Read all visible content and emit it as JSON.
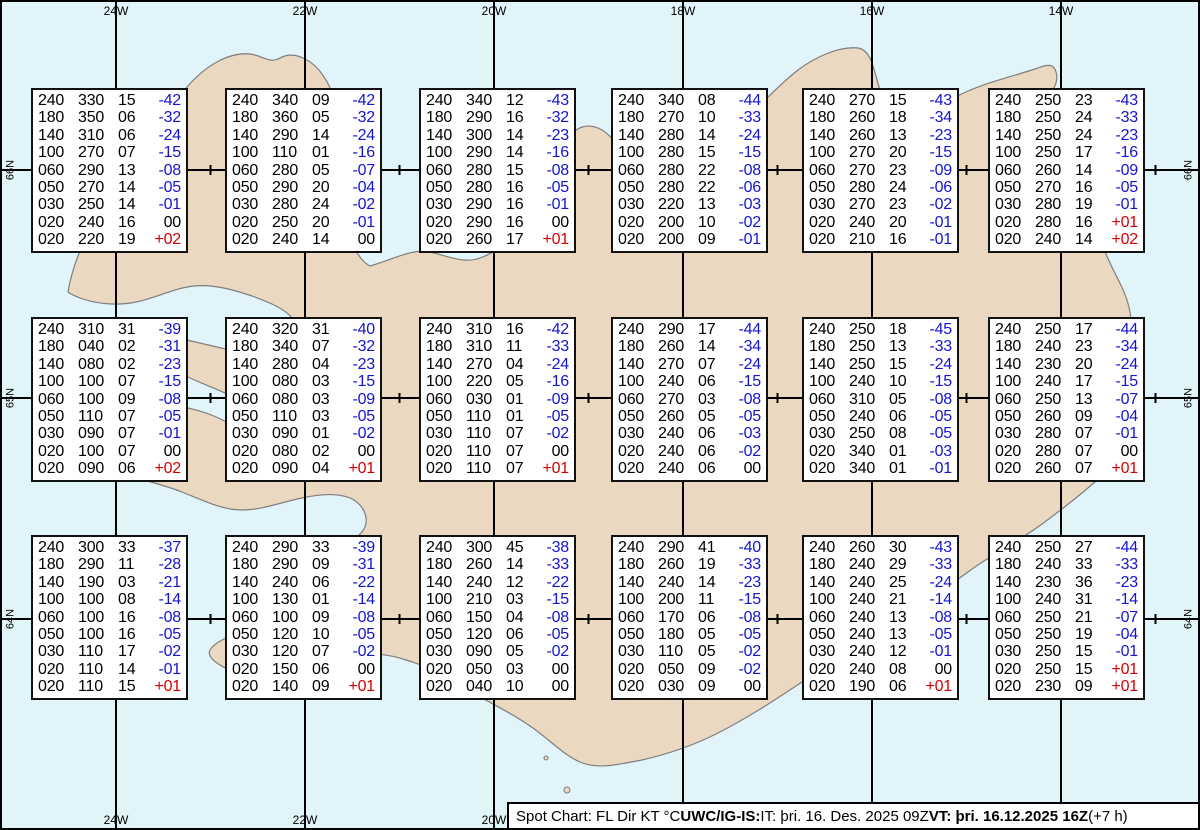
{
  "map": {
    "sea_color": "#e1f4fa",
    "land_color": "#ead8c1",
    "coast_color": "#7e7e7e",
    "grid_color": "#000000",
    "meridians": [
      {
        "label": "24W",
        "x": 116
      },
      {
        "label": "22W",
        "x": 305
      },
      {
        "label": "20W",
        "x": 494
      },
      {
        "label": "18W",
        "x": 683
      },
      {
        "label": "16W",
        "x": 872
      },
      {
        "label": "14W",
        "x": 1061
      }
    ],
    "parallels": [
      {
        "label": "66N",
        "y": 170
      },
      {
        "label": "65N",
        "y": 398
      },
      {
        "label": "64N",
        "y": 619
      }
    ],
    "tick_xs": [
      210.5,
      399.5,
      588.5,
      777.5,
      966.5,
      1155.5
    ]
  },
  "spot_columns": [
    "FL",
    "Dir",
    "KT",
    "°C"
  ],
  "colors": {
    "temp_negative": "#1414d4",
    "temp_positive": "#d40000",
    "text": "#000000"
  },
  "spot_boxes": [
    {
      "x": 31,
      "y": 88,
      "rows": [
        [
          "240",
          "330",
          "15",
          "-42"
        ],
        [
          "180",
          "350",
          "06",
          "-32"
        ],
        [
          "140",
          "310",
          "06",
          "-24"
        ],
        [
          "100",
          "270",
          "07",
          "-15"
        ],
        [
          "060",
          "290",
          "13",
          "-08"
        ],
        [
          "050",
          "270",
          "14",
          "-05"
        ],
        [
          "030",
          "250",
          "14",
          "-01"
        ],
        [
          "020",
          "240",
          "16",
          "00"
        ],
        [
          "020",
          "220",
          "19",
          "+02"
        ]
      ]
    },
    {
      "x": 225,
      "y": 88,
      "rows": [
        [
          "240",
          "340",
          "09",
          "-42"
        ],
        [
          "180",
          "360",
          "05",
          "-32"
        ],
        [
          "140",
          "290",
          "14",
          "-24"
        ],
        [
          "100",
          "110",
          "01",
          "-16"
        ],
        [
          "060",
          "280",
          "05",
          "-07"
        ],
        [
          "050",
          "290",
          "20",
          "-04"
        ],
        [
          "030",
          "280",
          "24",
          "-02"
        ],
        [
          "020",
          "250",
          "20",
          "-01"
        ],
        [
          "020",
          "240",
          "14",
          "00"
        ]
      ]
    },
    {
      "x": 419,
      "y": 88,
      "rows": [
        [
          "240",
          "340",
          "12",
          "-43"
        ],
        [
          "180",
          "290",
          "16",
          "-32"
        ],
        [
          "140",
          "300",
          "14",
          "-23"
        ],
        [
          "100",
          "290",
          "14",
          "-16"
        ],
        [
          "060",
          "280",
          "15",
          "-08"
        ],
        [
          "050",
          "280",
          "16",
          "-05"
        ],
        [
          "030",
          "290",
          "16",
          "-01"
        ],
        [
          "020",
          "290",
          "16",
          "00"
        ],
        [
          "020",
          "260",
          "17",
          "+01"
        ]
      ]
    },
    {
      "x": 611,
      "y": 88,
      "rows": [
        [
          "240",
          "340",
          "08",
          "-44"
        ],
        [
          "180",
          "270",
          "10",
          "-33"
        ],
        [
          "140",
          "280",
          "14",
          "-24"
        ],
        [
          "100",
          "280",
          "15",
          "-15"
        ],
        [
          "060",
          "280",
          "22",
          "-08"
        ],
        [
          "050",
          "280",
          "22",
          "-06"
        ],
        [
          "030",
          "220",
          "13",
          "-03"
        ],
        [
          "020",
          "200",
          "10",
          "-02"
        ],
        [
          "020",
          "200",
          "09",
          "-01"
        ]
      ]
    },
    {
      "x": 802,
      "y": 88,
      "rows": [
        [
          "240",
          "270",
          "15",
          "-43"
        ],
        [
          "180",
          "260",
          "18",
          "-34"
        ],
        [
          "140",
          "260",
          "13",
          "-23"
        ],
        [
          "100",
          "270",
          "20",
          "-15"
        ],
        [
          "060",
          "270",
          "23",
          "-09"
        ],
        [
          "050",
          "280",
          "24",
          "-06"
        ],
        [
          "030",
          "270",
          "23",
          "-02"
        ],
        [
          "020",
          "240",
          "20",
          "-01"
        ],
        [
          "020",
          "210",
          "16",
          "-01"
        ]
      ]
    },
    {
      "x": 988,
      "y": 88,
      "rows": [
        [
          "240",
          "250",
          "23",
          "-43"
        ],
        [
          "180",
          "250",
          "24",
          "-33"
        ],
        [
          "140",
          "250",
          "24",
          "-23"
        ],
        [
          "100",
          "250",
          "17",
          "-16"
        ],
        [
          "060",
          "260",
          "14",
          "-09"
        ],
        [
          "050",
          "270",
          "16",
          "-05"
        ],
        [
          "030",
          "280",
          "19",
          "-01"
        ],
        [
          "020",
          "280",
          "16",
          "+01"
        ],
        [
          "020",
          "240",
          "14",
          "+02"
        ]
      ]
    },
    {
      "x": 31,
      "y": 317,
      "rows": [
        [
          "240",
          "310",
          "31",
          "-39"
        ],
        [
          "180",
          "040",
          "02",
          "-31"
        ],
        [
          "140",
          "080",
          "02",
          "-23"
        ],
        [
          "100",
          "100",
          "07",
          "-15"
        ],
        [
          "060",
          "100",
          "09",
          "-08"
        ],
        [
          "050",
          "110",
          "07",
          "-05"
        ],
        [
          "030",
          "090",
          "07",
          "-01"
        ],
        [
          "020",
          "100",
          "07",
          "00"
        ],
        [
          "020",
          "090",
          "06",
          "+02"
        ]
      ]
    },
    {
      "x": 225,
      "y": 317,
      "rows": [
        [
          "240",
          "320",
          "31",
          "-40"
        ],
        [
          "180",
          "340",
          "07",
          "-32"
        ],
        [
          "140",
          "280",
          "04",
          "-23"
        ],
        [
          "100",
          "080",
          "03",
          "-15"
        ],
        [
          "060",
          "080",
          "03",
          "-09"
        ],
        [
          "050",
          "110",
          "03",
          "-05"
        ],
        [
          "030",
          "090",
          "01",
          "-02"
        ],
        [
          "020",
          "080",
          "02",
          "00"
        ],
        [
          "020",
          "090",
          "04",
          "+01"
        ]
      ]
    },
    {
      "x": 419,
      "y": 317,
      "rows": [
        [
          "240",
          "310",
          "16",
          "-42"
        ],
        [
          "180",
          "310",
          "11",
          "-33"
        ],
        [
          "140",
          "270",
          "04",
          "-24"
        ],
        [
          "100",
          "220",
          "05",
          "-16"
        ],
        [
          "060",
          "030",
          "01",
          "-09"
        ],
        [
          "050",
          "110",
          "01",
          "-05"
        ],
        [
          "030",
          "110",
          "07",
          "-02"
        ],
        [
          "020",
          "110",
          "07",
          "00"
        ],
        [
          "020",
          "110",
          "07",
          "+01"
        ]
      ]
    },
    {
      "x": 611,
      "y": 317,
      "rows": [
        [
          "240",
          "290",
          "17",
          "-44"
        ],
        [
          "180",
          "260",
          "14",
          "-34"
        ],
        [
          "140",
          "270",
          "07",
          "-24"
        ],
        [
          "100",
          "240",
          "06",
          "-15"
        ],
        [
          "060",
          "270",
          "03",
          "-08"
        ],
        [
          "050",
          "260",
          "05",
          "-05"
        ],
        [
          "030",
          "240",
          "06",
          "-03"
        ],
        [
          "020",
          "240",
          "06",
          "-02"
        ],
        [
          "020",
          "240",
          "06",
          "00"
        ]
      ]
    },
    {
      "x": 802,
      "y": 317,
      "rows": [
        [
          "240",
          "250",
          "18",
          "-45"
        ],
        [
          "180",
          "250",
          "13",
          "-33"
        ],
        [
          "140",
          "250",
          "15",
          "-24"
        ],
        [
          "100",
          "240",
          "10",
          "-15"
        ],
        [
          "060",
          "310",
          "05",
          "-08"
        ],
        [
          "050",
          "240",
          "06",
          "-05"
        ],
        [
          "030",
          "250",
          "08",
          "-05"
        ],
        [
          "020",
          "340",
          "01",
          "-03"
        ],
        [
          "020",
          "340",
          "01",
          "-01"
        ]
      ]
    },
    {
      "x": 988,
      "y": 317,
      "rows": [
        [
          "240",
          "250",
          "17",
          "-44"
        ],
        [
          "180",
          "240",
          "23",
          "-34"
        ],
        [
          "140",
          "230",
          "20",
          "-24"
        ],
        [
          "100",
          "240",
          "17",
          "-15"
        ],
        [
          "060",
          "250",
          "13",
          "-07"
        ],
        [
          "050",
          "260",
          "09",
          "-04"
        ],
        [
          "030",
          "280",
          "07",
          "-01"
        ],
        [
          "020",
          "280",
          "07",
          "00"
        ],
        [
          "020",
          "260",
          "07",
          "+01"
        ]
      ]
    },
    {
      "x": 31,
      "y": 535,
      "rows": [
        [
          "240",
          "300",
          "33",
          "-37"
        ],
        [
          "180",
          "290",
          "11",
          "-28"
        ],
        [
          "140",
          "190",
          "03",
          "-21"
        ],
        [
          "100",
          "100",
          "08",
          "-14"
        ],
        [
          "060",
          "100",
          "16",
          "-08"
        ],
        [
          "050",
          "100",
          "16",
          "-05"
        ],
        [
          "030",
          "110",
          "17",
          "-02"
        ],
        [
          "020",
          "110",
          "14",
          "-01"
        ],
        [
          "020",
          "110",
          "15",
          "+01"
        ]
      ]
    },
    {
      "x": 225,
      "y": 535,
      "rows": [
        [
          "240",
          "290",
          "33",
          "-39"
        ],
        [
          "180",
          "290",
          "09",
          "-31"
        ],
        [
          "140",
          "240",
          "06",
          "-22"
        ],
        [
          "100",
          "130",
          "01",
          "-14"
        ],
        [
          "060",
          "100",
          "09",
          "-08"
        ],
        [
          "050",
          "120",
          "10",
          "-05"
        ],
        [
          "030",
          "120",
          "07",
          "-02"
        ],
        [
          "020",
          "150",
          "06",
          "00"
        ],
        [
          "020",
          "140",
          "09",
          "+01"
        ]
      ]
    },
    {
      "x": 419,
      "y": 535,
      "rows": [
        [
          "240",
          "300",
          "45",
          "-38"
        ],
        [
          "180",
          "260",
          "14",
          "-33"
        ],
        [
          "140",
          "240",
          "12",
          "-22"
        ],
        [
          "100",
          "210",
          "03",
          "-15"
        ],
        [
          "060",
          "150",
          "04",
          "-08"
        ],
        [
          "050",
          "120",
          "06",
          "-05"
        ],
        [
          "030",
          "090",
          "05",
          "-02"
        ],
        [
          "020",
          "050",
          "03",
          "00"
        ],
        [
          "020",
          "040",
          "10",
          "00"
        ]
      ]
    },
    {
      "x": 611,
      "y": 535,
      "rows": [
        [
          "240",
          "290",
          "41",
          "-40"
        ],
        [
          "180",
          "260",
          "19",
          "-33"
        ],
        [
          "140",
          "240",
          "14",
          "-23"
        ],
        [
          "100",
          "200",
          "11",
          "-15"
        ],
        [
          "060",
          "170",
          "06",
          "-08"
        ],
        [
          "050",
          "180",
          "05",
          "-05"
        ],
        [
          "030",
          "110",
          "05",
          "-02"
        ],
        [
          "020",
          "050",
          "09",
          "-02"
        ],
        [
          "020",
          "030",
          "09",
          "00"
        ]
      ]
    },
    {
      "x": 802,
      "y": 535,
      "rows": [
        [
          "240",
          "260",
          "30",
          "-43"
        ],
        [
          "180",
          "240",
          "29",
          "-33"
        ],
        [
          "140",
          "240",
          "25",
          "-24"
        ],
        [
          "100",
          "240",
          "21",
          "-14"
        ],
        [
          "060",
          "240",
          "13",
          "-08"
        ],
        [
          "050",
          "240",
          "13",
          "-05"
        ],
        [
          "030",
          "240",
          "12",
          "-01"
        ],
        [
          "020",
          "240",
          "08",
          "00"
        ],
        [
          "020",
          "190",
          "06",
          "+01"
        ]
      ]
    },
    {
      "x": 988,
      "y": 535,
      "rows": [
        [
          "240",
          "250",
          "27",
          "-44"
        ],
        [
          "180",
          "240",
          "33",
          "-33"
        ],
        [
          "140",
          "230",
          "36",
          "-23"
        ],
        [
          "100",
          "240",
          "31",
          "-14"
        ],
        [
          "060",
          "250",
          "21",
          "-07"
        ],
        [
          "050",
          "250",
          "19",
          "-04"
        ],
        [
          "030",
          "250",
          "15",
          "-01"
        ],
        [
          "020",
          "250",
          "15",
          "+01"
        ],
        [
          "020",
          "230",
          "09",
          "+01"
        ]
      ]
    }
  ],
  "footer": {
    "segments": [
      {
        "text": "Spot Chart: FL Dir KT °C ",
        "bold": false
      },
      {
        "text": "UWC/IG-IS:",
        "bold": true
      },
      {
        "text": " IT: þri. 16. Des. 2025 09Z ",
        "bold": false
      },
      {
        "text": "VT: þri. 16.12.2025 16Z",
        "bold": true
      },
      {
        "text": " (+7 h)",
        "bold": false
      }
    ]
  }
}
